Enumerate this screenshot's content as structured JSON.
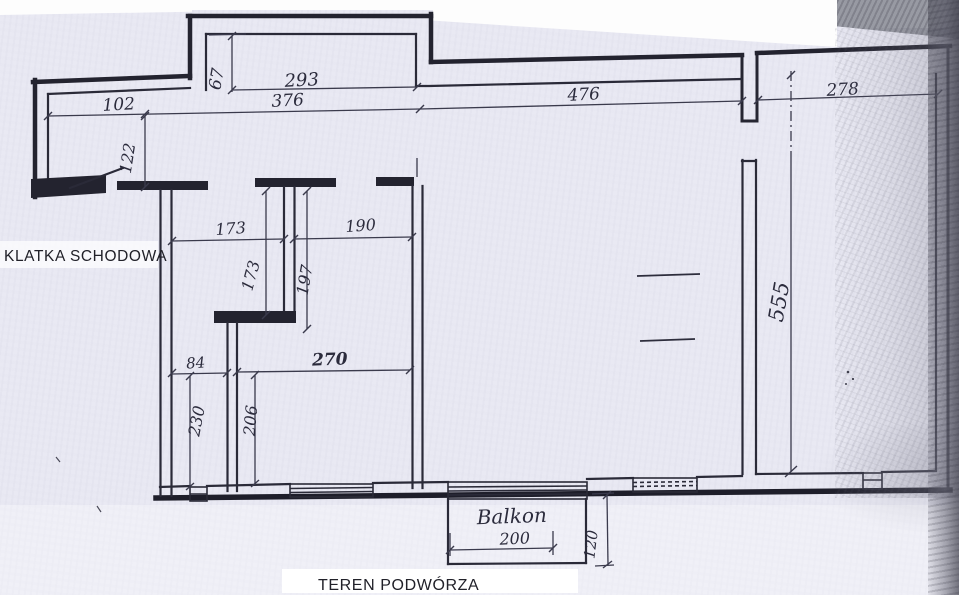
{
  "labels": {
    "staircase": "KLATKA SCHODOWA",
    "courtyard": "TEREN PODWÓRZA",
    "balcony": "Balkon"
  },
  "dims": {
    "recess_depth": "67",
    "recess_width": "293",
    "entry_width": "102",
    "top_span_left": "376",
    "top_span_mid": "476",
    "top_span_right": "278",
    "entry_depth": "122",
    "room1_width": "173",
    "hall_width": "190",
    "room1_depth": "173",
    "hall_depth": "197",
    "bath_width": "84",
    "room2_width": "270",
    "bath_depth": "230",
    "room2_depth": "206",
    "main_depth": "555",
    "balcony_width": "200",
    "balcony_depth": "120"
  },
  "colors": {
    "paper": "#e9e9f3",
    "ink": "#23232f",
    "dimension_ink": "#3a3a4c",
    "scan_shadow": "#989aa3",
    "highlight": "#ffffff"
  }
}
